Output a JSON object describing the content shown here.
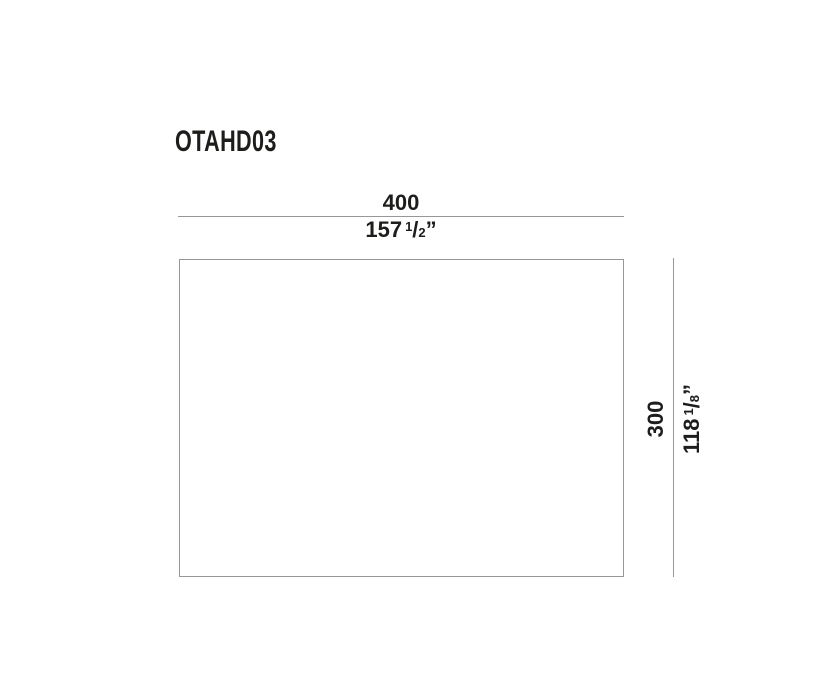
{
  "product_code": "OTAHD03",
  "diagram": {
    "width_dimension": {
      "mm": "400",
      "inches_whole": "157",
      "fraction_numerator": "1",
      "fraction_slash": "/",
      "fraction_denominator": "2",
      "unit_mark": "”"
    },
    "height_dimension": {
      "mm": "300",
      "inches_whole": "118",
      "fraction_numerator": "1",
      "fraction_slash": "/",
      "fraction_denominator": "8",
      "unit_mark": "”"
    }
  },
  "colors": {
    "ink": "#1d1d1b",
    "line": "#97979a",
    "background": "#ffffff"
  }
}
